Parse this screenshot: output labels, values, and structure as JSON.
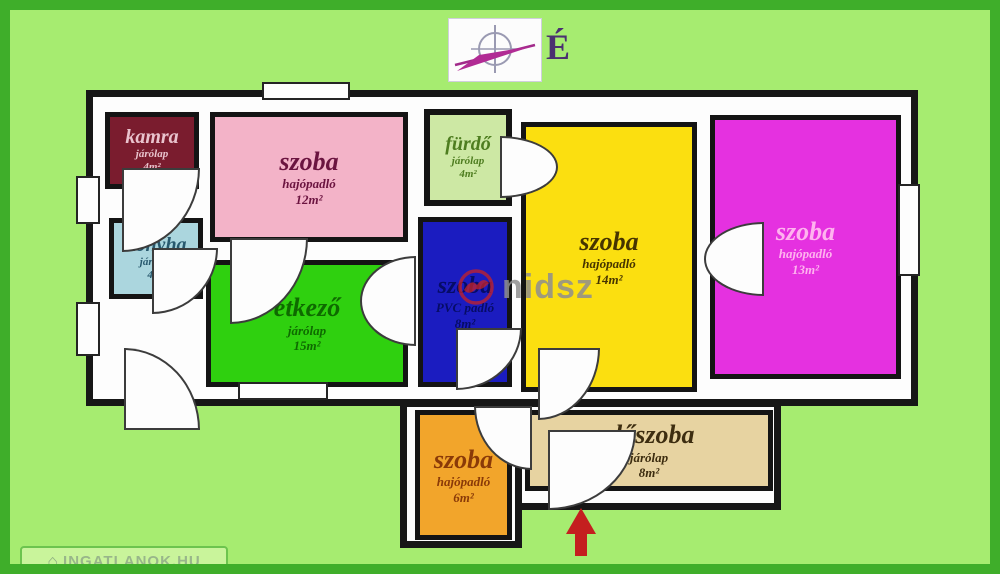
{
  "compass": {
    "north_label": "É"
  },
  "watermark": {
    "text": "nidsz"
  },
  "badge": {
    "label": "INGATLANOK.HU"
  },
  "entrance": {
    "symbol": "entrance-arrow"
  },
  "palette": {
    "background": "#a6ec70",
    "frame": "#3fae2a",
    "wall": "#171717",
    "arrow_red": "#c41f1f",
    "watermark_gray": "#8f8f8f",
    "watermark_logo_red": "#cc2222"
  },
  "rooms": [
    {
      "id": "kamra",
      "name": "kamra",
      "floor": "járólap",
      "area": "4m²",
      "fill": "#7a1c2e",
      "text": "#e9c3cd"
    },
    {
      "id": "szoba-pink",
      "name": "szoba",
      "floor": "hajópadló",
      "area": "12m²",
      "fill": "#f3b3c8",
      "text": "#6b1440"
    },
    {
      "id": "furdo",
      "name": "fürdő",
      "floor": "járólap",
      "area": "4m²",
      "fill": "#cde8a4",
      "text": "#4e7d20"
    },
    {
      "id": "szoba-yellow",
      "name": "szoba",
      "floor": "hajópadló",
      "area": "14m²",
      "fill": "#fbdf10",
      "text": "#463400"
    },
    {
      "id": "szoba-magenta",
      "name": "szoba",
      "floor": "hajópadló",
      "area": "13m²",
      "fill": "#e531e0",
      "text": "#ffb3ef"
    },
    {
      "id": "konyha",
      "name": "konyha",
      "floor": "járólap",
      "area": "4m²",
      "fill": "#abd6de",
      "text": "#28596e"
    },
    {
      "id": "etkezo",
      "name": "étkező",
      "floor": "járólap",
      "area": "15m²",
      "fill": "#2fd00f",
      "text": "#0e6a00"
    },
    {
      "id": "szoba-blue",
      "name": "szoba",
      "floor": "PVC padló",
      "area": "8m²",
      "fill": "#1b1cc0",
      "text": "#060c66"
    },
    {
      "id": "szoba-orange",
      "name": "szoba",
      "floor": "hajópadló",
      "area": "6m²",
      "fill": "#f2a52b",
      "text": "#8a3a08"
    },
    {
      "id": "eloszoba",
      "name": "előszoba",
      "floor": "járólap",
      "area": "8m²",
      "fill": "#e7d3a1",
      "text": "#3d2d10"
    }
  ]
}
